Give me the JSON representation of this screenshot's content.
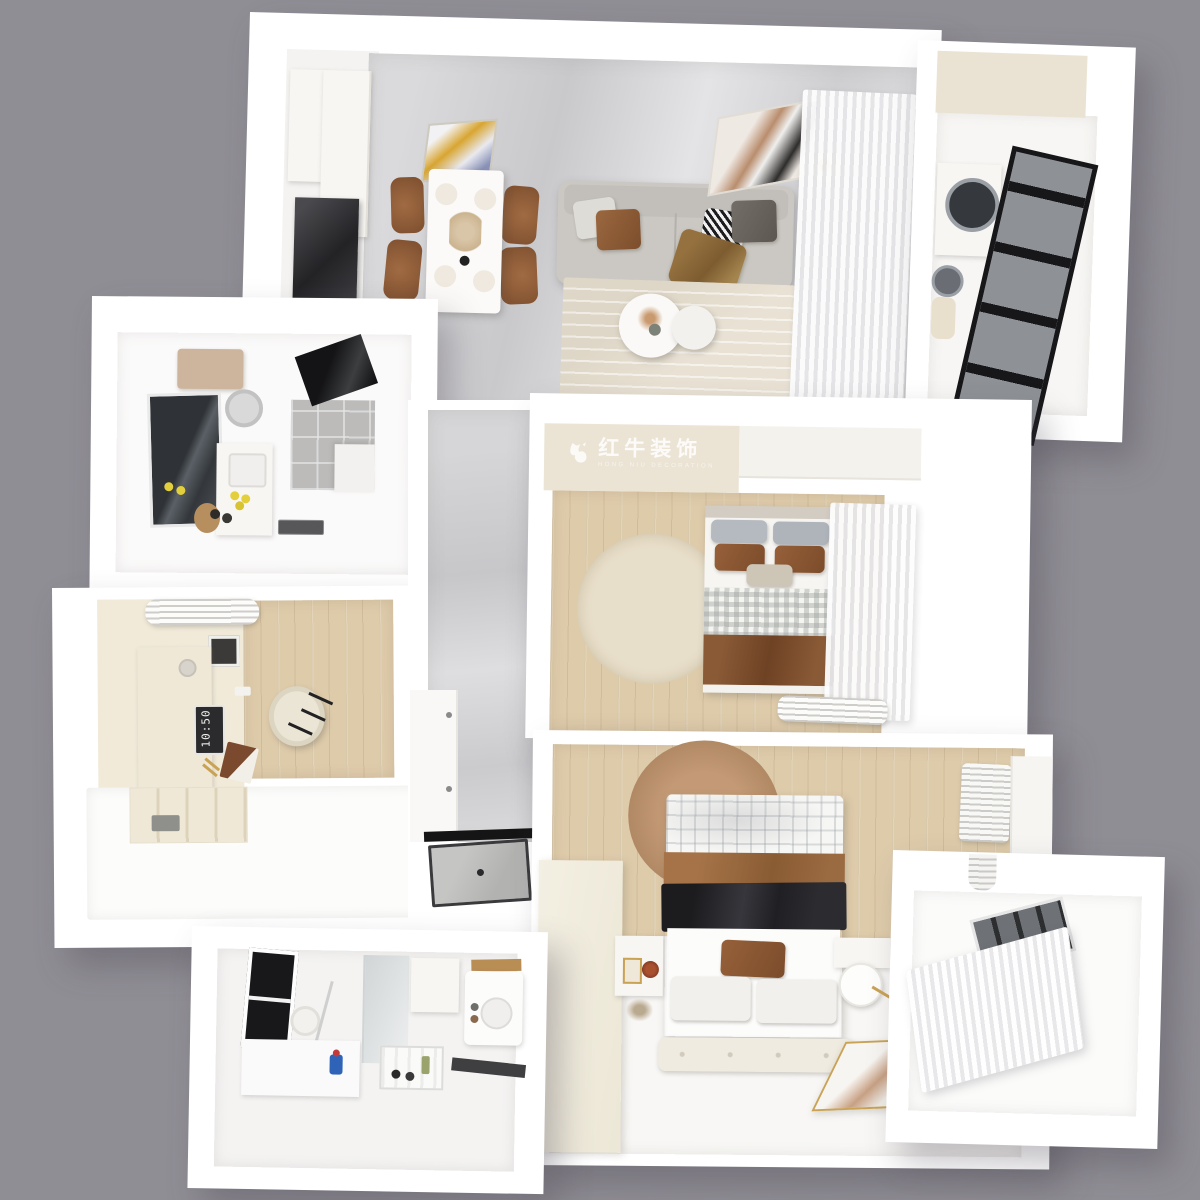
{
  "scene": {
    "kind": "3d-dollhouse-floorplan-render",
    "background_color": "#908e95",
    "wall_color": "#ffffff",
    "marble_floor_color": "#d4d4d7",
    "wood_floor_color": "#decbaa",
    "cream_wall_color": "#ebe4d4",
    "accent_brown": "#8a5a35",
    "black_accent": "#1d1d1f",
    "gold_accent": "#c9a254"
  },
  "watermark": {
    "logo": "bull-icon",
    "title": "红牛装饰",
    "subtitle": "HONG NIU DECORATION"
  },
  "study": {
    "monitor_time": "10:50"
  },
  "rooms": [
    {
      "name": "living-dining",
      "furniture": [
        "kitchen-sideboard",
        "dark-cabinet",
        "dining-wall-art",
        "dining-table",
        "dining-chair",
        "sofa",
        "cushions",
        "throw-blanket",
        "area-rug",
        "coffee-table",
        "floor-lamp",
        "sofa-wall-art",
        "sheer-curtain"
      ]
    },
    {
      "name": "laundry-balcony",
      "furniture": [
        "washing-machine",
        "laundry-basket",
        "black-frame-window"
      ]
    },
    {
      "name": "bathroom-main",
      "furniture": [
        "water-heater",
        "exhaust-fan",
        "vanity-mirror",
        "vanity-counter",
        "lemon-bowl",
        "shower-area",
        "glass-partition",
        "brand-plaque"
      ]
    },
    {
      "name": "study",
      "furniture": [
        "air-conditioner",
        "desk",
        "monitor-clock",
        "office-chair",
        "platform-bed",
        "storage-compartments",
        "magazine"
      ]
    },
    {
      "name": "hallway",
      "furniture": [
        "wardrobe",
        "entry-door",
        "door-threshold"
      ]
    },
    {
      "name": "bedroom-second",
      "furniture": [
        "bed",
        "pillows",
        "gingham-duvet",
        "brown-blanket",
        "round-rug",
        "sheer-curtain",
        "air-conditioner",
        "closet"
      ]
    },
    {
      "name": "bedroom-master",
      "furniture": [
        "bed",
        "plaid-blanket",
        "black-blanket",
        "pillows",
        "round-rug-brown",
        "nightstand",
        "side-table",
        "bench",
        "floor-mirror",
        "air-conditioner",
        "wardrobe"
      ]
    },
    {
      "name": "bathroom-second",
      "furniture": [
        "black-frame-window",
        "counter",
        "drying-rack",
        "shelf-unit",
        "vanity-sink",
        "cleaning-supplies"
      ]
    },
    {
      "name": "balcony-small",
      "furniture": [
        "pendant-light",
        "window",
        "sheer-curtain"
      ]
    }
  ]
}
